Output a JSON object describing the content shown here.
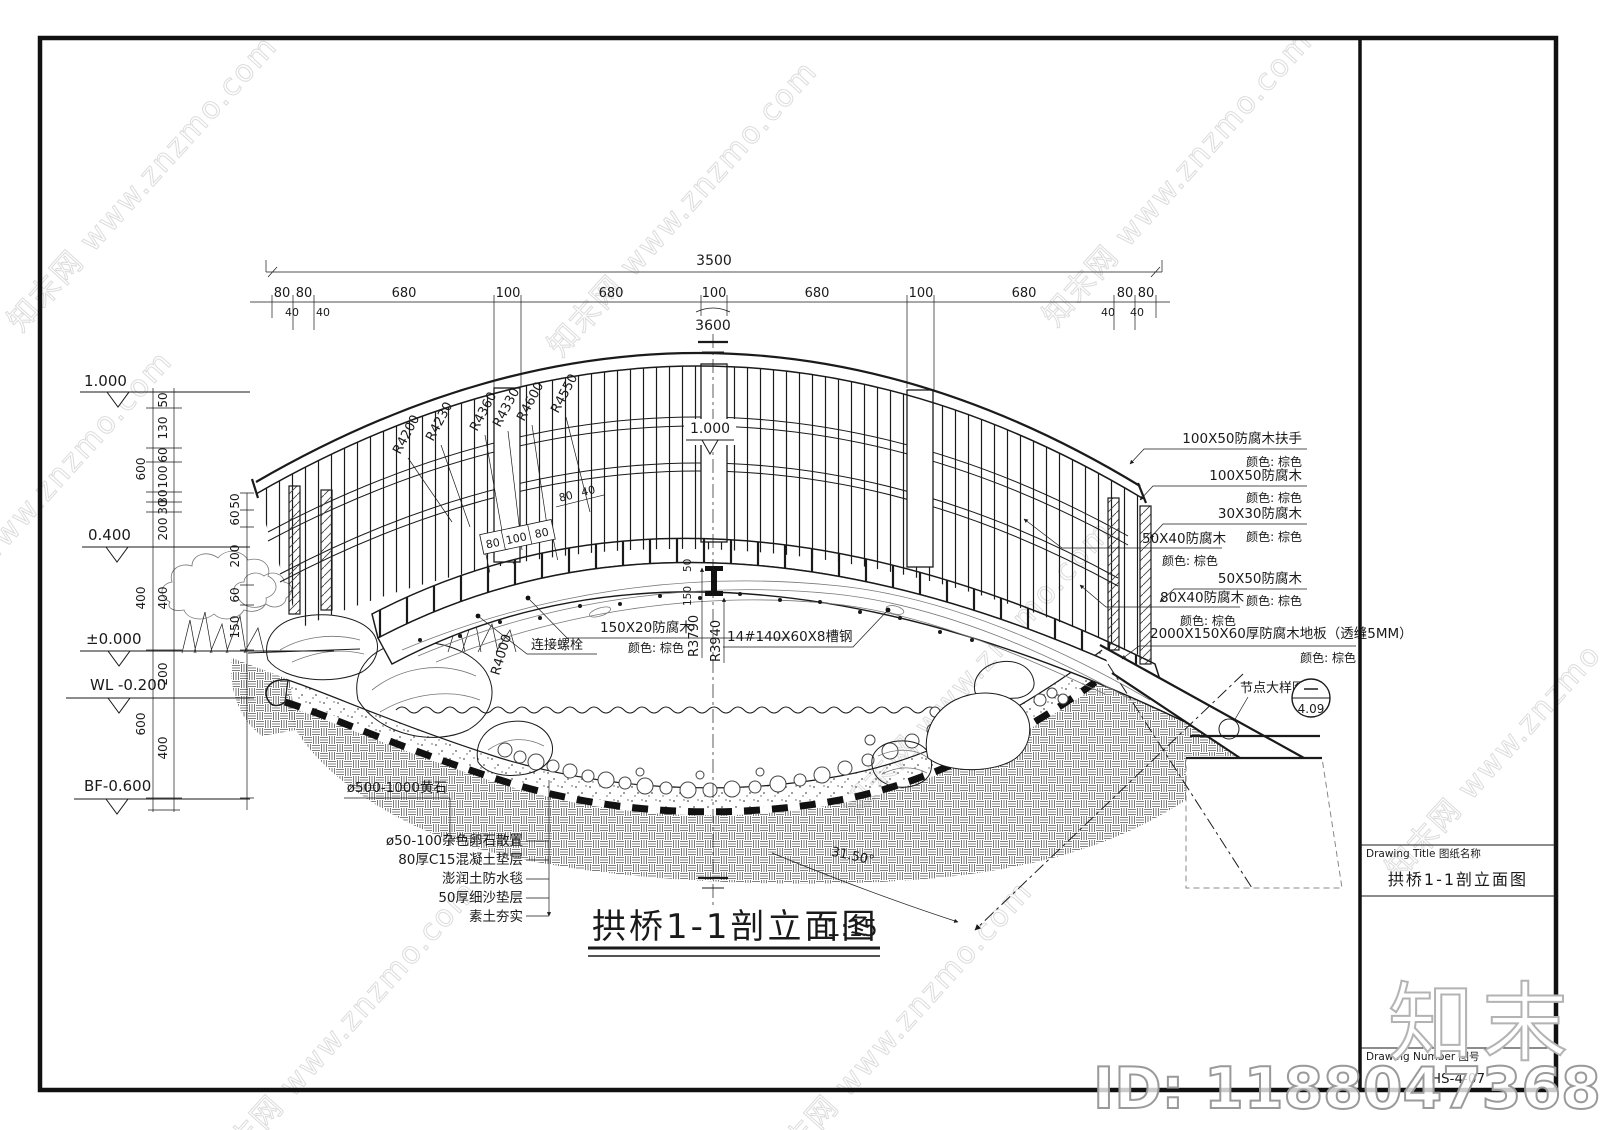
{
  "sheet": {
    "title_block": {
      "drawing_title_label": "Drawing Title  图纸名称",
      "drawing_title": "拱桥1-1剖立面图",
      "drawing_number_label": "Drawing Number  图号",
      "drawing_number": "HS-4-07"
    },
    "watermark": {
      "diagonal": "知末网 www.znzmo.com",
      "logo": "知末",
      "id": "ID: 1188047368"
    }
  },
  "drawing": {
    "view_title": "拱桥1-1剖立面图",
    "scale": "1:15",
    "top_dimensions": {
      "overall": "3500",
      "segments": [
        "80",
        "80",
        "680",
        "100",
        "680",
        "100",
        "680",
        "100",
        "680",
        "80",
        "80"
      ],
      "sub_segments": [
        "40",
        "40",
        "40",
        "40"
      ],
      "arc_length": "3600"
    },
    "elevation_markers": [
      "1.000",
      "0.400",
      "±0.000",
      "WL -0.200",
      "BF-0.600"
    ],
    "deck_elevation": "1.000",
    "left_dim_chain_outer": [
      "600",
      "400",
      "600"
    ],
    "left_dim_chain_inner": [
      "50",
      "130",
      "60",
      "100",
      "30",
      "30",
      "200",
      "400",
      "200",
      "400"
    ],
    "post_dim_chain": [
      "50",
      "60",
      "200",
      "60",
      "150"
    ],
    "deck_dims": [
      "80",
      "100",
      "80"
    ],
    "rail_dims": [
      "80",
      "40"
    ],
    "center_dims": [
      "50",
      "150"
    ],
    "radius_labels": [
      "R4200",
      "R4230",
      "R4360",
      "R4330",
      "R4600",
      "R4550"
    ],
    "lower_radius_labels": [
      "R4000",
      "R3790",
      "R3940"
    ],
    "angle_label": "31.50°",
    "callouts_right": [
      {
        "text": "100X50防腐木扶手",
        "color": "颜色: 棕色"
      },
      {
        "text": "100X50防腐木",
        "color": "颜色: 棕色"
      },
      {
        "text": "30X30防腐木",
        "color": "颜色: 棕色"
      },
      {
        "text": "50X40防腐木",
        "color": "颜色: 棕色"
      },
      {
        "text": "50X50防腐木",
        "color": "颜色: 棕色"
      },
      {
        "text": "80X40防腐木",
        "color": "颜色: 棕色"
      },
      {
        "text": "2000X150X60厚防腐木地板（透缝5MM）",
        "color": "颜色: 棕色"
      }
    ],
    "callouts_center": {
      "bolt": "连接螺栓",
      "plank_text": "150X20防腐木",
      "plank_color": "颜色: 棕色",
      "channel": "14#140X60X8槽钢"
    },
    "callouts_bottom": [
      "ø500-1000黄石",
      "ø50-100杂色卵石散置",
      "80厚C15混凝土垫层",
      "澎润土防水毯",
      "50厚细沙垫层",
      "素土夯实"
    ],
    "detail_callout": {
      "label": "节点大样图",
      "number": "4.09"
    }
  }
}
